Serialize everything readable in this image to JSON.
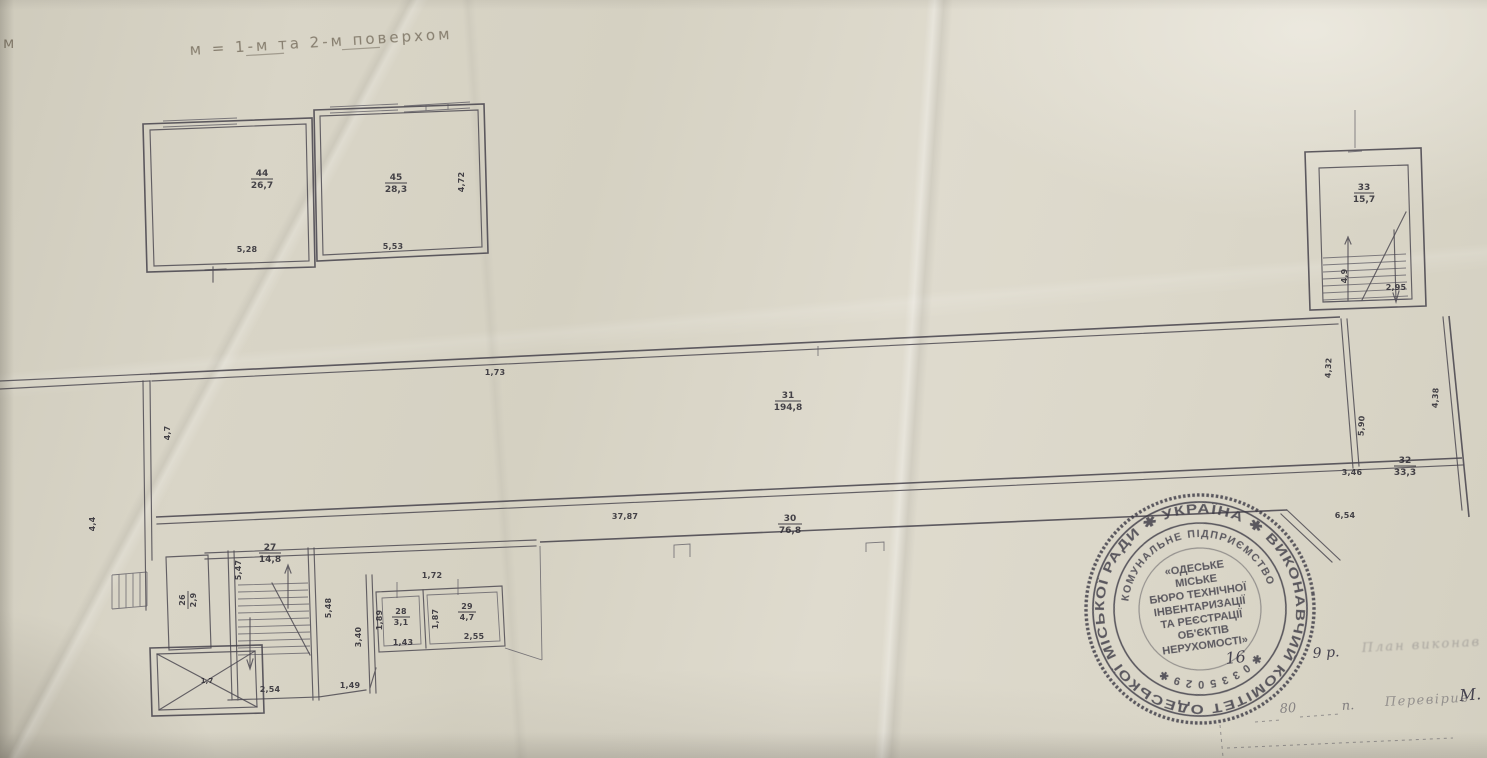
{
  "document": {
    "kind": "scanned BTI floor-plan sheet (antresole between floors), Odesa, Ukraine",
    "corner_mark": "м",
    "title": "м = 1-м та 2-м поверхом"
  },
  "labels": {
    "corner": "м",
    "title": "м = 1-м та 2-м поверхом",
    "mz1_no": "44",
    "mz1_area": "26,7",
    "mz2_no": "45",
    "mz2_area": "28,3",
    "mz_b1": "5,28",
    "mz_b2": "5,53",
    "mz_r": "4,72",
    "hall_no": "31",
    "hall_area": "194,8",
    "hall_top": "1,73",
    "hall_left": "4,7",
    "corr_no": "30",
    "corr_area": "76,8",
    "corr_len": "37,87",
    "right_no": "32",
    "right_area": "33,3",
    "d_346": "3,46",
    "d_654": "6,54",
    "d_438": "4,38",
    "d_590": "5,90",
    "d_432": "4,32",
    "st_no": "33",
    "st_area": "15,7",
    "st_b": "2,95",
    "st_l": "4,9",
    "r27_no": "27",
    "r27_area": "14,8",
    "d_547": "5,47",
    "d_548": "5,48",
    "d_340": "3,40",
    "d_254": "2,54",
    "d_149": "1,49",
    "r26_no": "26",
    "r26_area": "2,9",
    "lift_no": "1,7",
    "r28_no": "28",
    "r28_area": "3,1",
    "d_143": "1,43",
    "d_189": "1,89",
    "r29_no": "29",
    "r29_area": "4,7",
    "d_255": "2,55",
    "d_187": "1,87",
    "d_172": "1,72",
    "left_dim": "4,4"
  },
  "stamp": {
    "outer_text": "УКРАЇНА  ✱  ВИКОНАВЧИЙ  КОМІТЕТ  ОДЕСЬКОЇ  МІСЬКОЇ  РАДИ  ✱",
    "middle_top": "КОМУНАЛЬНЕ ПІДПРИЄМСТВО",
    "middle_bottom": "✱ 0 3 3 5 0 2 9 ✱",
    "center_lines": [
      "«ОДЕСЬКЕ",
      "МІСЬКЕ",
      "БЮРО ТЕХНІЧНОЇ",
      "ІНВЕНТАРИЗАЦІЇ",
      "ТА РЕЄСТРАЦІЇ",
      "ОБ'ЄКТІВ",
      "НЕРУХОМОСТІ»"
    ]
  },
  "handwriting": {
    "number_16": "16",
    "year": "9 р.",
    "line1_faded": "План виконав",
    "number_80": "80",
    "p_abbrev": "п.",
    "checked": "Перевірив",
    "initial": "М."
  }
}
